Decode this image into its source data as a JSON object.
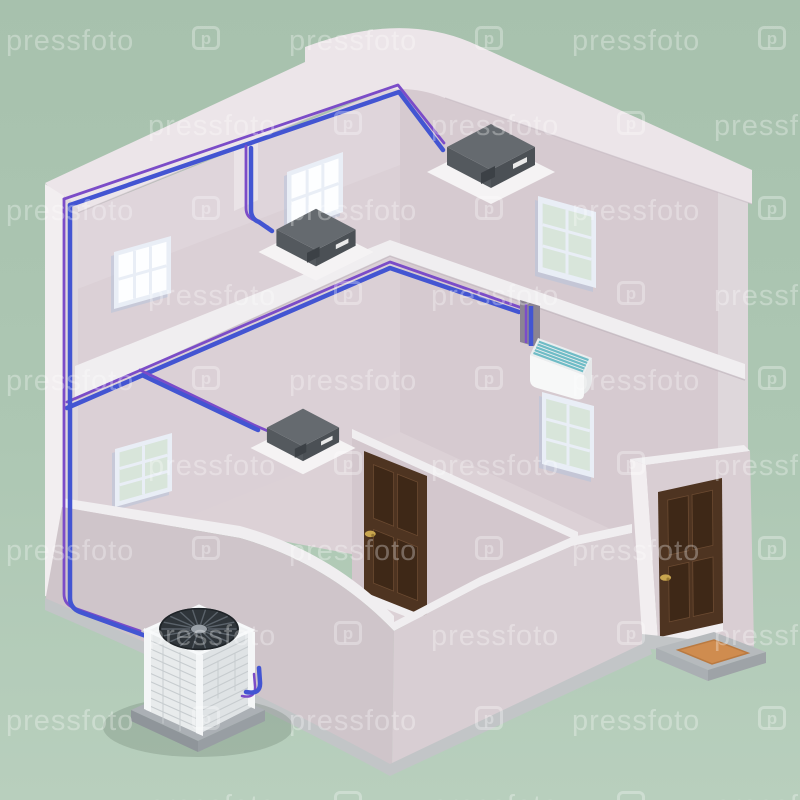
{
  "canvas": {
    "width": 800,
    "height": 800
  },
  "scene": {
    "description": "Isometric 3D cutaway of a two-storey house showing a multi-split air conditioning system with refrigerant piping",
    "objects": [
      {
        "name": "outdoor-condenser-unit",
        "label": "outdoor condensing unit with top fan"
      },
      {
        "name": "ceiling-cassette-unit-upper-right",
        "label": "ceiling cassette indoor unit, upper floor right"
      },
      {
        "name": "ceiling-cassette-unit-upper-left",
        "label": "ceiling cassette indoor unit, upper floor left"
      },
      {
        "name": "ceiling-cassette-unit-lower",
        "label": "ceiling cassette indoor unit, lower floor"
      },
      {
        "name": "wall-split-unit",
        "label": "wall mounted split indoor unit"
      },
      {
        "name": "refrigerant-pipes",
        "label": "blue and violet refrigerant pipe pair"
      },
      {
        "name": "interior-door",
        "label": "brown interior panel door"
      },
      {
        "name": "entry-door",
        "label": "brown exterior entry door"
      },
      {
        "name": "doormat",
        "label": "orange doormat on grey step"
      },
      {
        "name": "windows",
        "label": "five gridded windows"
      }
    ]
  },
  "watermark": {
    "text": "pressfoto",
    "logo": "pressfoto-camera-logo",
    "logo_glyph": "p",
    "grid": {
      "y_start": 25,
      "y_step": 85,
      "x_even": [
        6,
        289,
        572
      ],
      "x_odd": [
        148,
        431,
        714
      ],
      "icon_dx": 186,
      "rows": 10
    }
  },
  "palette": {
    "bg_top": "#a7c1ad",
    "bg_mid": "#adc7b3",
    "bg_bottom": "#b8cfbd",
    "wm_color": "rgba(255,255,255,0.30)",
    "roof_band": "#ece5e9",
    "trim": "#f0eef0",
    "wall_left": "#dbd0d6",
    "wall_right": "#d6cad0",
    "wall_a": "#d3c7cd",
    "corner_band": "#ded7db",
    "cut_edge": "#f2eef0",
    "cut_edge_shade": "#e0d8dc",
    "chase": "#eae3e7",
    "recess": "#8b8492",
    "floor": "#dcd1d6",
    "stub_left": "#cfc5ca",
    "stub_right": "#d8ced3",
    "frag_wall": "#d9ced3",
    "plinth": "#c2c5c7",
    "plinth_dark": "#b2b6b9",
    "pipe_blue": "#4355d2",
    "pipe_violet": "#7b4cc8",
    "door": "#4e3421",
    "door_panel": "#3e2817",
    "door_edge": "#6b4a31",
    "handle": "#c9a64f",
    "mat": "#cf8c4f",
    "mat_edge": "#ba7a41",
    "step": "#b6babd",
    "step_side": "#9ea3a7",
    "step_side2": "#aaafb3",
    "unit_top": "#656a6f",
    "unit_left": "#54595e",
    "unit_right": "#4b5055",
    "unit_stub": "#3c4146",
    "flange": "#f5f3f4",
    "label": "#e9e9e9",
    "split_white": "#f7f8f8",
    "split_top": "#eaeeef",
    "split_end": "#e6e8e9",
    "split_teal": "#6fbcc6",
    "ou_top": "#f0f2f3",
    "ou_left": "#e8ebec",
    "ou_right": "#dfe3e5",
    "ou_line": "#c7cccf",
    "ou_post": "#f4f6f7",
    "fan_dark": "#2f353a",
    "fan_blade": "#5a626a",
    "fan_hub": "#9aa1a8",
    "pad_top": "#abb0b5",
    "pad_left": "#8f959a",
    "pad_right": "#989ea3",
    "win_frame": "#e9eef6",
    "win_frame_shade": "#b7c3da",
    "pane_white": "#fdfeff",
    "pane_green": "#d8e5da",
    "shadow": "#5a6e5f"
  }
}
